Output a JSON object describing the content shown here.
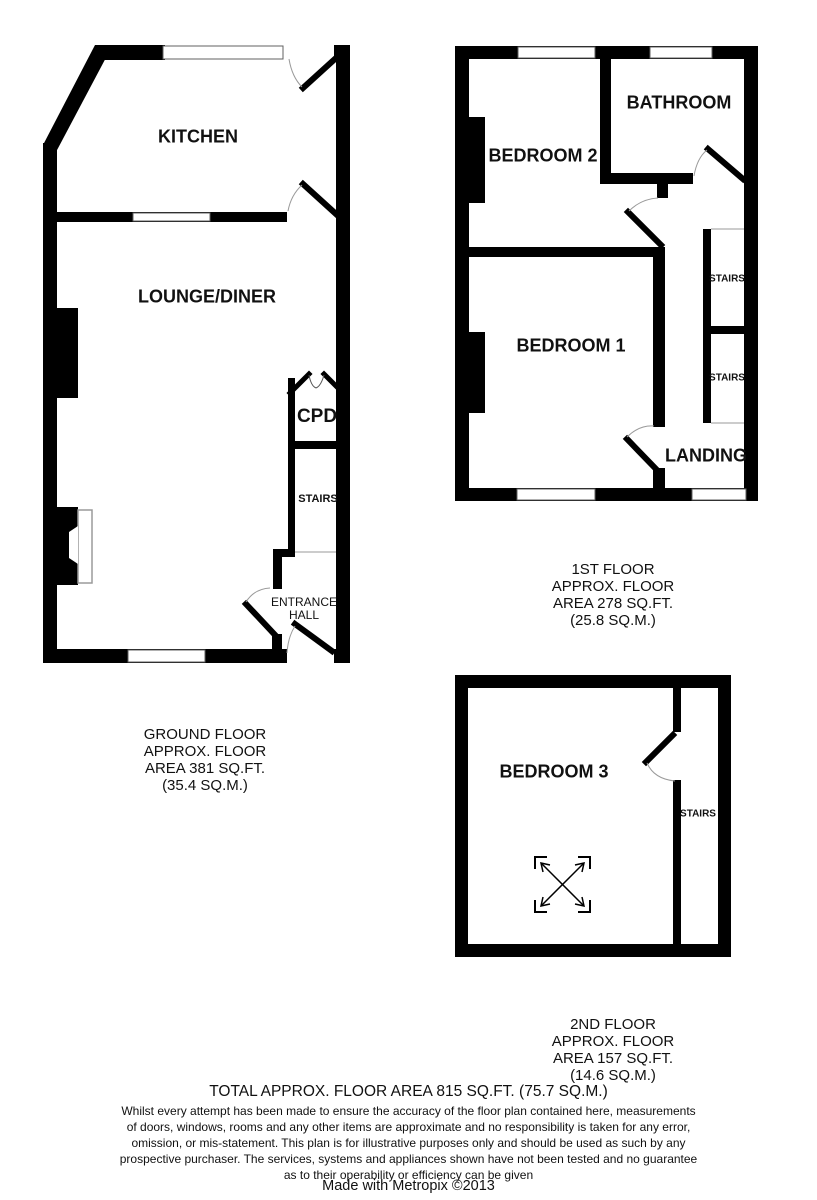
{
  "colors": {
    "wall": "#000000",
    "background": "#ffffff",
    "window_outline": "#606060",
    "door_arc": "#9a9a9a"
  },
  "floors": {
    "ground": {
      "labels": {
        "kitchen": "KITCHEN",
        "lounge_diner": "LOUNGE/DINER",
        "cpd": "CPD",
        "stairs": "STAIRS",
        "entrance_hall_line1": "ENTRANCE",
        "entrance_hall_line2": "HALL"
      },
      "caption": [
        "GROUND FLOOR",
        "APPROX. FLOOR",
        "AREA 381 SQ.FT.",
        "(35.4 SQ.M.)"
      ]
    },
    "first": {
      "labels": {
        "bedroom2": "BEDROOM 2",
        "bathroom": "BATHROOM",
        "bedroom1": "BEDROOM 1",
        "stairs_upper": "STAIRS",
        "stairs_lower": "STAIRS",
        "landing": "LANDING"
      },
      "caption": [
        "1ST FLOOR",
        "APPROX. FLOOR",
        "AREA 278 SQ.FT.",
        "(25.8 SQ.M.)"
      ]
    },
    "second": {
      "labels": {
        "bedroom3": "BEDROOM 3",
        "stairs": "STAIRS"
      },
      "caption": [
        "2ND FLOOR",
        "APPROX. FLOOR",
        "AREA 157 SQ.FT.",
        "(14.6 SQ.M.)"
      ]
    }
  },
  "summary": {
    "total_area": "TOTAL APPROX. FLOOR AREA 815 SQ.FT. (75.7 SQ.M.)"
  },
  "disclaimer": {
    "lines": [
      "Whilst every attempt has been made to ensure the accuracy of the floor plan contained here, measurements",
      "of doors, windows, rooms and any other items are approximate and no responsibility is taken for any error,",
      "omission, or mis-statement. This plan is for illustrative purposes only and should be used as such by any",
      "prospective purchaser. The services, systems and appliances shown have not been tested and no guarantee",
      "as to their operability or efficiency can be given"
    ]
  },
  "credit": "Made with Metropix ©2013"
}
